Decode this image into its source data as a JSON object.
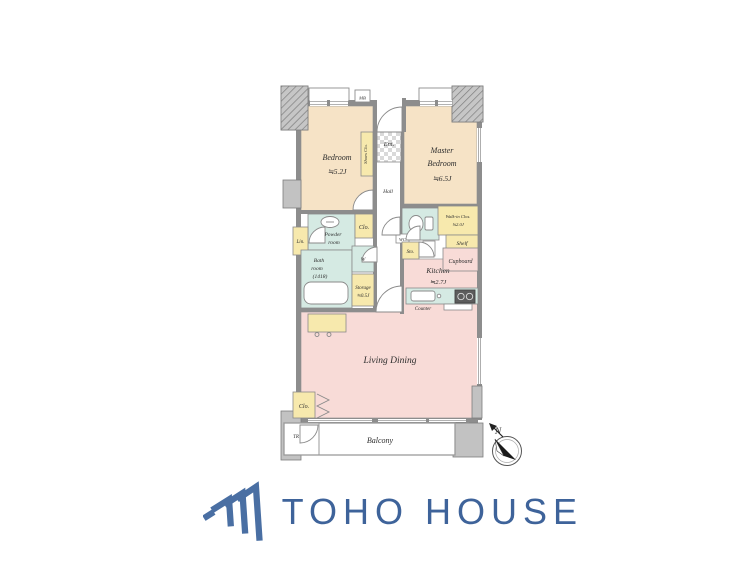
{
  "floor_plan": {
    "labels": {
      "bedroom_name": "Bedroom",
      "bedroom_size": "≒5.2J",
      "master_line1": "Master",
      "master_line2": "Bedroom",
      "master_size": "≒6.5J",
      "ent": "Ent.",
      "hall": "Hall",
      "shoes_clo": "Shoes Clo.",
      "mb": "MB",
      "powder_line1": "Powder",
      "powder_line2": "room",
      "clo_mid": "Clo.",
      "lin": "Lin.",
      "bath_line1": "Bath",
      "bath_line2": "room",
      "bath_line3": "(1418)",
      "washer": "W",
      "storage_line1": "Storage",
      "storage_line2": "≒0.5J",
      "wc": "WC",
      "wic_line1": "Walk-in Clos.",
      "wic_line2": "≒2.0J",
      "shelf": "Shelf",
      "sto": "Sto.",
      "cupboard": "Cupboard",
      "kitchen_name": "Kitchen",
      "kitchen_size": "≒2.7J",
      "counter": "Counter",
      "living_dining": "Living Dining",
      "clo_bottom": "Clo.",
      "tr": "TR",
      "balcony": "Balcony"
    },
    "compass": {
      "north": "N"
    }
  },
  "footer": {
    "brand": "TOHO HOUSE"
  },
  "colors": {
    "bedroom_tan": "#f6e3c6",
    "living_pink": "#f8dbd7",
    "wet_area_teal": "#d5eae3",
    "closet_yellow": "#f7e9ad",
    "wall_gray": "#8d8d8d",
    "column_gray": "#c2c2c2",
    "brand_blue": "#3e639a"
  }
}
